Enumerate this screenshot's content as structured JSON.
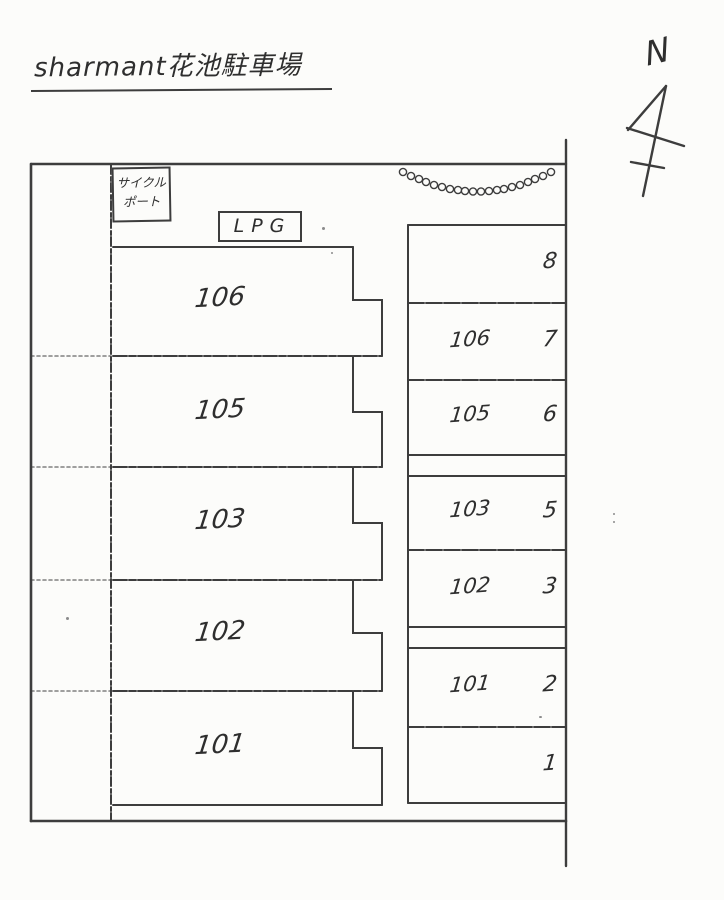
{
  "paper": {
    "background": "#fcfcfa",
    "ink": "#3d3d3d"
  },
  "title": {
    "text": "sharmant花池駐車場"
  },
  "compass": {
    "north_label": "N"
  },
  "facilities": {
    "cycle_port_line1": "サイクル",
    "cycle_port_line2": "ポート",
    "lpg_label": "LPG"
  },
  "left_column_spaces": [
    {
      "label": "106"
    },
    {
      "label": "105"
    },
    {
      "label": "103"
    },
    {
      "label": "102"
    },
    {
      "label": "101"
    }
  ],
  "right_column_spaces": [
    {
      "unit": "",
      "number": "8"
    },
    {
      "unit": "106",
      "number": "7"
    },
    {
      "unit": "105",
      "number": "6"
    },
    {
      "unit": "103",
      "number": "5"
    },
    {
      "unit": "102",
      "number": "3"
    },
    {
      "unit": "101",
      "number": "2"
    },
    {
      "unit": "",
      "number": "1"
    }
  ]
}
